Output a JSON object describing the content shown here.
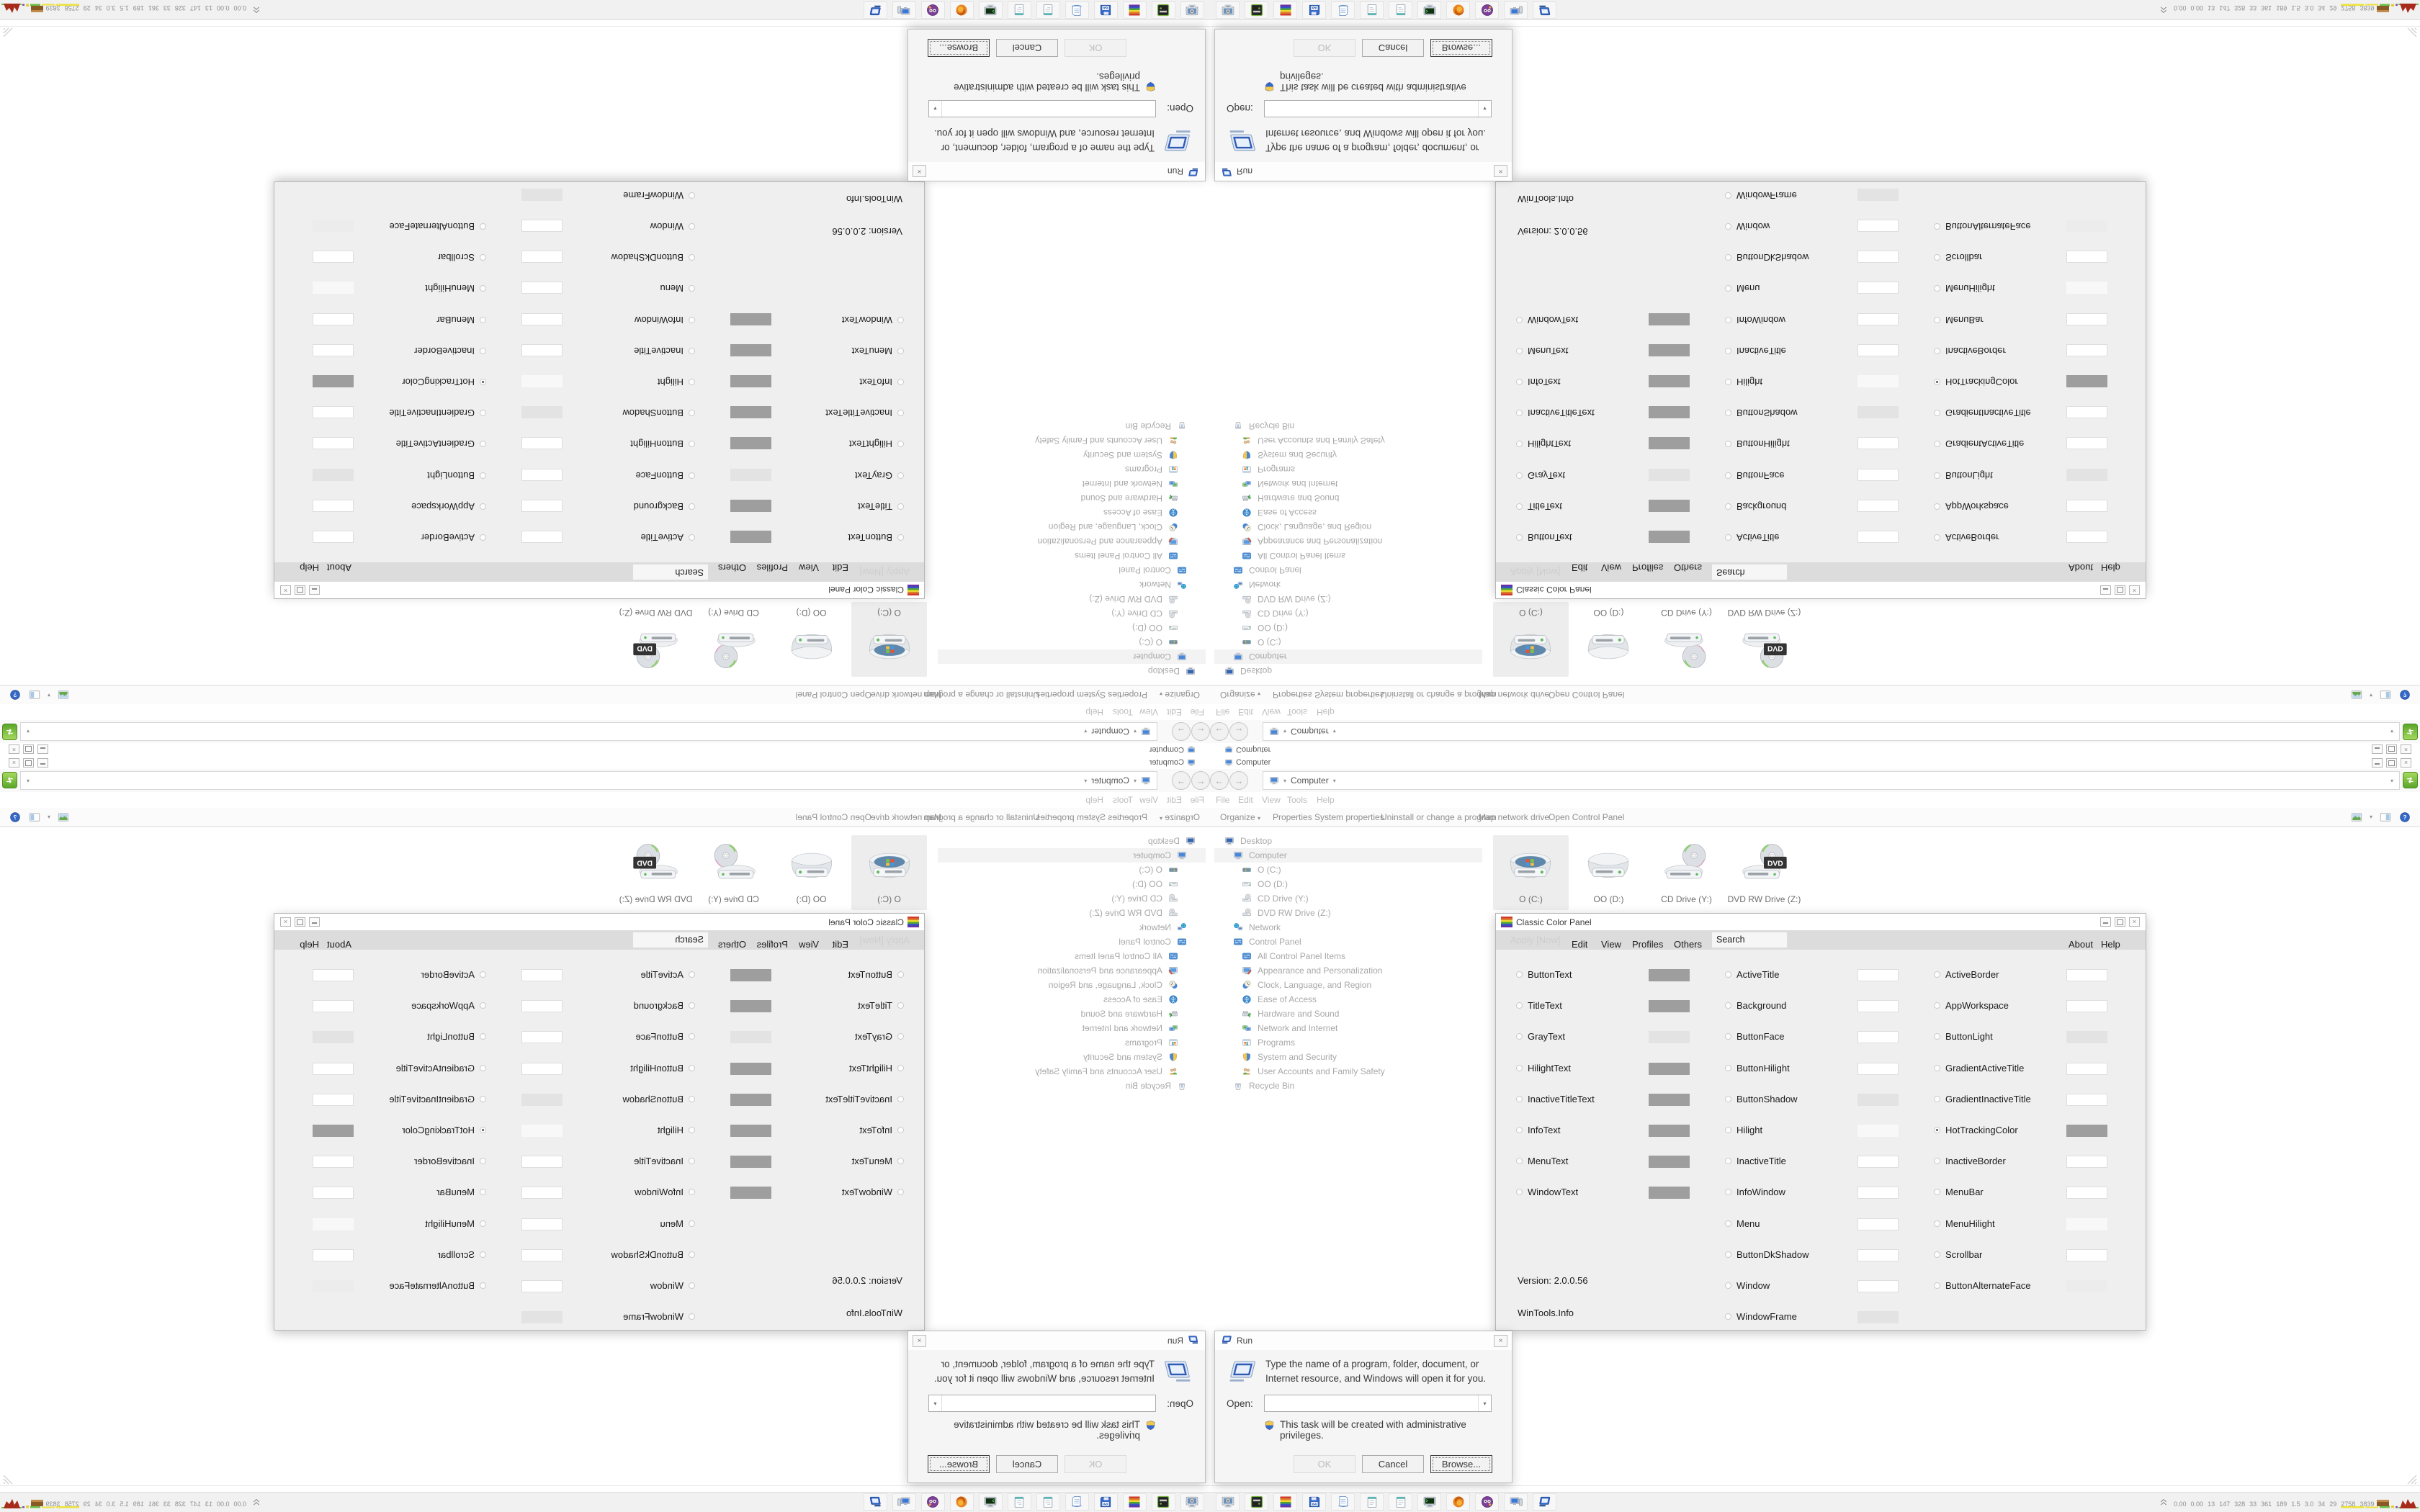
{
  "explorer": {
    "window_title": "Computer",
    "address": {
      "crumb": "Computer"
    },
    "menu_items": [
      "File",
      "Edit",
      "View",
      "Tools",
      "Help"
    ],
    "menu_x": [
      8,
      39,
      72,
      107,
      148
    ],
    "toolbar": {
      "organize_label": "Organize",
      "items": [
        "Properties",
        "System properties",
        "Uninstall or change a program",
        "Map network drive",
        "Open Control Panel"
      ],
      "items_x": [
        87,
        145,
        237,
        373,
        470
      ]
    },
    "drives": [
      {
        "label": "O (C:)",
        "icon": "hdd-windows",
        "selected": true
      },
      {
        "label": "OO (D:)",
        "icon": "hdd",
        "selected": false
      },
      {
        "label": "CD Drive (Y:)",
        "icon": "optical",
        "selected": false
      },
      {
        "label": "DVD RW Drive (Z:)",
        "icon": "optical-dvd",
        "selected": false
      }
    ],
    "tree": [
      {
        "label": "Desktop",
        "icon": "desktop",
        "indent": 0,
        "selected": false
      },
      {
        "label": "Computer",
        "icon": "computer",
        "indent": 1,
        "selected": true
      },
      {
        "label": "O (C:)",
        "icon": "hdd-windows",
        "indent": 2,
        "selected": false
      },
      {
        "label": "OO (D:)",
        "icon": "hdd",
        "indent": 2,
        "selected": false
      },
      {
        "label": "CD Drive (Y:)",
        "icon": "optical",
        "indent": 2,
        "selected": false
      },
      {
        "label": "DVD RW Drive (Z:)",
        "icon": "optical",
        "indent": 2,
        "selected": false
      },
      {
        "label": "Network",
        "icon": "network",
        "indent": 1,
        "selected": false
      },
      {
        "label": "Control Panel",
        "icon": "control-panel",
        "indent": 1,
        "selected": false
      },
      {
        "label": "All Control Panel Items",
        "icon": "control-panel",
        "indent": 2,
        "selected": false
      },
      {
        "label": "Appearance and Personalization",
        "icon": "appearance",
        "indent": 2,
        "selected": false
      },
      {
        "label": "Clock, Language, and Region",
        "icon": "clock",
        "indent": 2,
        "selected": false
      },
      {
        "label": "Ease of Access",
        "icon": "ease",
        "indent": 2,
        "selected": false
      },
      {
        "label": "Hardware and Sound",
        "icon": "hardware",
        "indent": 2,
        "selected": false
      },
      {
        "label": "Network and Internet",
        "icon": "net-internet",
        "indent": 2,
        "selected": false
      },
      {
        "label": "Programs",
        "icon": "programs",
        "indent": 2,
        "selected": false
      },
      {
        "label": "System and Security",
        "icon": "security",
        "indent": 2,
        "selected": false
      },
      {
        "label": "User Accounts and Family Safety",
        "icon": "users",
        "indent": 2,
        "selected": false
      },
      {
        "label": "Recycle Bin",
        "icon": "recycle",
        "indent": 1,
        "selected": false
      }
    ]
  },
  "color_panel": {
    "title": "Classic Color Panel",
    "menu": {
      "apply_label": "Apply [Now]",
      "items": [
        "Edit",
        "View",
        "Profiles",
        "Others"
      ],
      "items_x": [
        105,
        146,
        189,
        247
      ],
      "search_text": "Search",
      "right_items": [
        "About",
        "Help"
      ],
      "right_items_x": [
        795,
        840
      ]
    },
    "columns": [
      [
        {
          "name": "ButtonText",
          "color": "#9e9e9e",
          "selected": false
        },
        {
          "name": "TitleText",
          "color": "#9e9e9e",
          "selected": false
        },
        {
          "name": "GrayText",
          "color": "#e3e3e3",
          "selected": false
        },
        {
          "name": "HilightText",
          "color": "#9e9e9e",
          "selected": false
        },
        {
          "name": "InactiveTitleText",
          "color": "#9e9e9e",
          "selected": false
        },
        {
          "name": "InfoText",
          "color": "#9e9e9e",
          "selected": false
        },
        {
          "name": "MenuText",
          "color": "#9e9e9e",
          "selected": false
        },
        {
          "name": "WindowText",
          "color": "#9e9e9e",
          "selected": false
        }
      ],
      [
        {
          "name": "ActiveTitle",
          "color": "#ffffff",
          "selected": false
        },
        {
          "name": "Background",
          "color": "#ffffff",
          "selected": false
        },
        {
          "name": "ButtonFace",
          "color": "#ffffff",
          "selected": false
        },
        {
          "name": "ButtonHilight",
          "color": "#ffffff",
          "selected": false
        },
        {
          "name": "ButtonShadow",
          "color": "#e3e3e3",
          "selected": false
        },
        {
          "name": "Hilight",
          "color": "#f8f8f8",
          "selected": false
        },
        {
          "name": "InactiveTitle",
          "color": "#ffffff",
          "selected": false
        },
        {
          "name": "InfoWindow",
          "color": "#ffffff",
          "selected": false
        },
        {
          "name": "Menu",
          "color": "#ffffff",
          "selected": false
        },
        {
          "name": "ButtonDkShadow",
          "color": "#ffffff",
          "selected": false
        },
        {
          "name": "Window",
          "color": "#ffffff",
          "selected": false
        },
        {
          "name": "WindowFrame",
          "color": "#e3e3e3",
          "selected": false
        }
      ],
      [
        {
          "name": "ActiveBorder",
          "color": "#ffffff",
          "selected": false
        },
        {
          "name": "AppWorkspace",
          "color": "#ffffff",
          "selected": false
        },
        {
          "name": "ButtonLight",
          "color": "#e3e3e3",
          "selected": false
        },
        {
          "name": "GradientActiveTitle",
          "color": "#ffffff",
          "selected": false
        },
        {
          "name": "GradientInactiveTitle",
          "color": "#ffffff",
          "selected": false
        },
        {
          "name": "HotTrackingColor",
          "color": "#9e9e9e",
          "selected": true
        },
        {
          "name": "InactiveBorder",
          "color": "#ffffff",
          "selected": false
        },
        {
          "name": "MenuBar",
          "color": "#ffffff",
          "selected": false
        },
        {
          "name": "MenuHilight",
          "color": "#f8f8f8",
          "selected": false
        },
        {
          "name": "Scrollbar",
          "color": "#ffffff",
          "selected": false
        },
        {
          "name": "ButtonAlternateFace",
          "color": "#ececec",
          "selected": false
        }
      ]
    ],
    "version": "Version: 2.0.0.56",
    "site": "WinTools.Info"
  },
  "run_dialog": {
    "title": "Run",
    "message": "Type the name of a program, folder, document, or Internet resource, and Windows will open it for you.",
    "open_label": "Open:",
    "open_value": "",
    "admin_note": "This task will be created with administrative privileges.",
    "buttons": {
      "ok": "OK",
      "cancel": "Cancel",
      "browse": "Browse..."
    }
  },
  "taskbar": {
    "apps": [
      {
        "icon": "display-settings"
      },
      {
        "icon": "disk-utility"
      },
      {
        "icon": "classic-color-panel"
      },
      {
        "icon": "save-64"
      },
      {
        "icon": "printer-doc"
      },
      {
        "icon": "notepad"
      },
      {
        "icon": "notepad"
      },
      {
        "icon": "console"
      },
      {
        "icon": "firefox"
      },
      {
        "icon": "purple-media"
      },
      {
        "icon": "remote-desktop"
      },
      {
        "icon": "run-app"
      }
    ],
    "tray_stats": [
      "0.00",
      "0.00",
      "13",
      "147",
      "328",
      "33",
      "361",
      "189",
      "1.5",
      "3.0",
      "34",
      "29",
      "2758",
      "3839"
    ]
  },
  "colors": {
    "menu_band": "#dcdcdc",
    "selection": "#ededed",
    "taskbar": "#f1f1f1",
    "go_button_green": "#5aa62a",
    "graph_yellow": "#ede23c",
    "graph_green": "#6fbf4a",
    "graph_brown": "#8a5a26",
    "graph_red": "#a82a1a"
  }
}
